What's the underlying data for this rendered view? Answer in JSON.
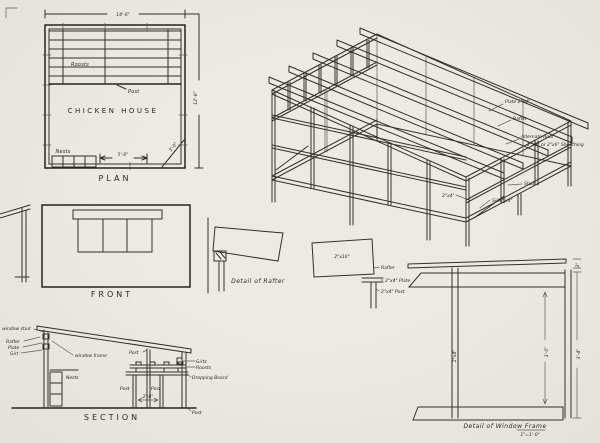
{
  "sheet": {
    "paper": "#e9e6e0",
    "ink": "#33302b"
  },
  "plan": {
    "caption": "PLAN",
    "room": "CHICKEN HOUSE",
    "dim_width": "14'-6\"",
    "dim_depth": "12'-6\"",
    "dim_nests": "5'-6\"",
    "dim_door": "3'-0\"",
    "roosts": "Roosts",
    "post": "Post",
    "nests": "Nests"
  },
  "front": {
    "caption": "FRONT"
  },
  "framing": {
    "plate": "Plate 2\"x4\"",
    "rafter": "Rafter",
    "roof_line1": "Alternate Roof",
    "roof_line2": "2\"x8\" or 2\"x6\" Sheathing",
    "stud": "Stud",
    "sill": "Sill 2\"x4\"",
    "girt": "2\"x4\""
  },
  "rafter_detail": {
    "caption": "Detail of Rafter"
  },
  "rafter_side": {
    "size": "2\"x10\"",
    "rafter": "Rafter",
    "plate": "2\"x4\" Plate",
    "post": "2\"x4\" Post"
  },
  "section": {
    "caption": "SECTION",
    "window_stud": "window stud",
    "rafter": "Rafter",
    "plate": "Plate",
    "girt": "Girt",
    "window_frame": "window frame",
    "nests": "Nests",
    "girts": "Girts",
    "roosts": "Roosts",
    "dropping_board": "Dropping Board",
    "post_roof": "Post",
    "post_left": "Post",
    "post_right_inner": "Post",
    "dim_posts": "2'-6\"",
    "post_wall": "Post"
  },
  "window_detail": {
    "caption": "Detail of Window Frame",
    "scale": "1\"=1'-0\"",
    "dim_height": "3'-4\"",
    "dim_opening": "3'-0\"",
    "dim_cap": "3\"",
    "stud_size": "2\"x4\""
  }
}
